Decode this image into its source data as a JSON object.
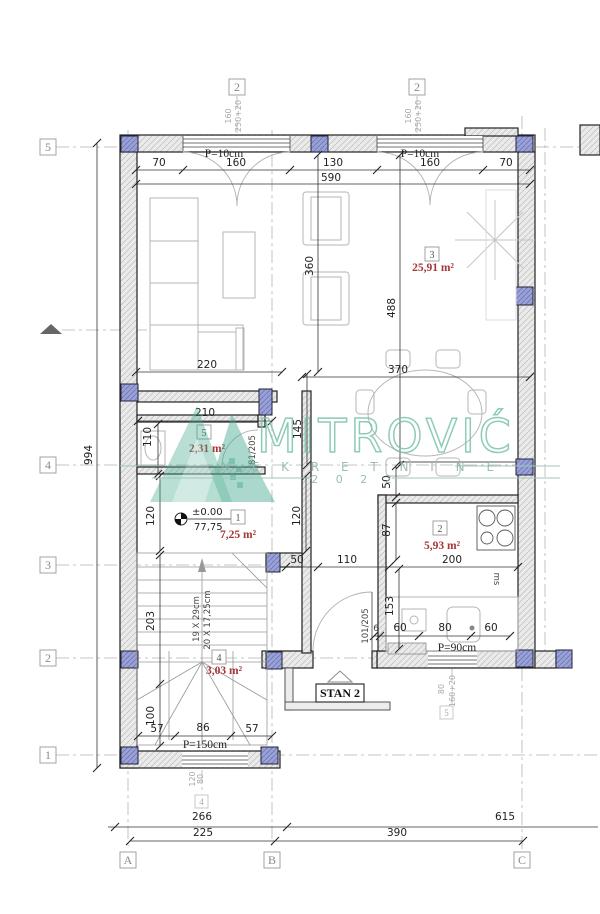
{
  "watermark": {
    "name": "MITROVIĆ",
    "tagline": "N E K R E T N I N E",
    "year": "2 0 2 2",
    "color": "#7cc2ad"
  },
  "unit": {
    "label": "STAN 2"
  },
  "grid": {
    "left": [
      "5",
      "4",
      "3",
      "2",
      "1"
    ],
    "top": [
      "2",
      "2"
    ],
    "bottom": [
      "A",
      "B",
      "C"
    ],
    "aux": [
      "4",
      "5"
    ]
  },
  "rooms": [
    {
      "num": "1",
      "area": "7,25 m²"
    },
    {
      "num": "2",
      "area": "5,93 m²"
    },
    {
      "num": "3",
      "area": "25,91 m²"
    },
    {
      "num": "4",
      "area": "3,03 m²"
    },
    {
      "num": "5",
      "area": "2,31 m²"
    }
  ],
  "level": {
    "datum": "±0.00",
    "value": "77,75"
  },
  "stairs_note": {
    "treads": "19 X 29cm",
    "risers": "20 X 17,25cm"
  },
  "doors": [
    "81/205",
    "101/205"
  ],
  "appliance_note": "ms",
  "parapets": {
    "top_left": "P=10cm",
    "top_right": "P=10cm",
    "kitchen": "P=90cm",
    "bottom": "P=150cm"
  },
  "window_tags": {
    "top": [
      "160",
      "250+20"
    ],
    "top2": [
      "160",
      "250+20"
    ],
    "kitchen": [
      "80",
      "160+20"
    ],
    "bottom": [
      "120",
      "80"
    ]
  },
  "dims": {
    "top": [
      "70",
      "160",
      "130",
      "160",
      "70"
    ],
    "top_total": "590",
    "left_total": "994",
    "mid": [
      "220",
      "370"
    ],
    "vert": [
      "360",
      "488",
      "145"
    ],
    "wc": [
      "210",
      "110"
    ],
    "hall": [
      "120",
      "120"
    ],
    "row3": [
      "50",
      "110",
      "200"
    ],
    "kitchen": [
      "50",
      "87",
      "153"
    ],
    "kitchen_row": [
      "6",
      "60",
      "80",
      "60"
    ],
    "stairs": [
      "203",
      "100"
    ],
    "bottom_inner": [
      "57",
      "86",
      "57"
    ],
    "site": [
      "266",
      "615",
      "225",
      "390"
    ]
  }
}
